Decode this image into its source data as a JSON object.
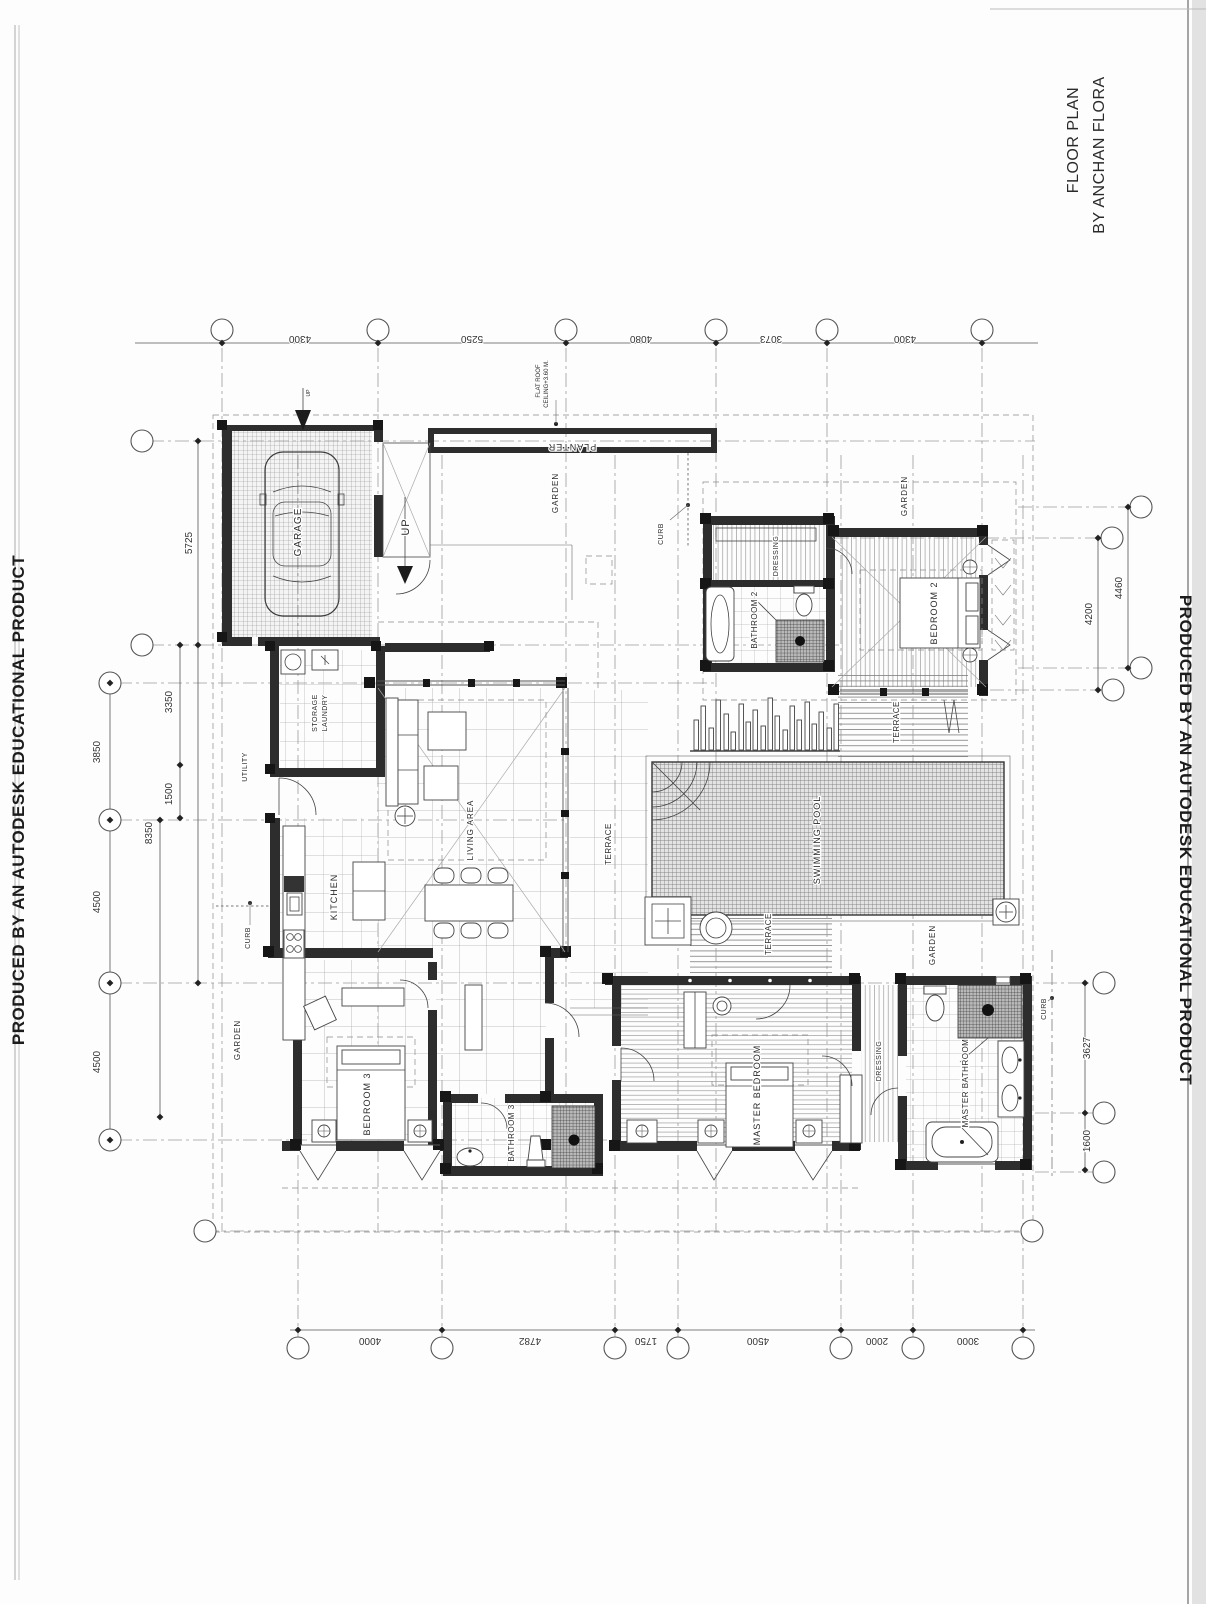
{
  "page": {
    "watermark_left": "PRODUCED BY AN AUTODESK EDUCATIONAL PRODUCT",
    "watermark_right": "PRODUCED BY AN AUTODESK EDUCATIONAL PRODUCT"
  },
  "title": {
    "line1": "FLOOR PLAN",
    "line2": "BY ANCHAN FLORA"
  },
  "rooms": [
    {
      "n": "garage-label",
      "t": "GARAGE",
      "x": 301,
      "y": 532,
      "r": -90,
      "s": 10,
      "sp": 1
    },
    {
      "n": "up-stair-label",
      "t": "UP",
      "x": 409,
      "y": 527,
      "r": -90,
      "s": 11,
      "sp": 1
    },
    {
      "n": "up-entry-label",
      "t": "UP",
      "x": 310,
      "y": 393,
      "r": -90,
      "s": 5,
      "sp": 0
    },
    {
      "n": "flat-roof-note-1",
      "t": "FLAT ROOF",
      "x": 540,
      "y": 381,
      "r": -90,
      "s": 6,
      "sp": 0
    },
    {
      "n": "flat-roof-note-2",
      "t": "CEILING+3.60 M.",
      "x": 548,
      "y": 384,
      "r": -90,
      "s": 6,
      "sp": 0
    },
    {
      "n": "planter-label",
      "t": "PLANTER",
      "x": 572,
      "y": 444,
      "r": 180,
      "s": 9,
      "sp": 1
    },
    {
      "n": "garden-top-label",
      "t": "GARDEN",
      "x": 558,
      "y": 493,
      "r": -90,
      "s": 8,
      "sp": 1
    },
    {
      "n": "curb-top-label",
      "t": "CURB",
      "x": 663,
      "y": 534,
      "r": -90,
      "s": 7,
      "sp": 0.5
    },
    {
      "n": "garden-tr-label",
      "t": "GARDEN",
      "x": 907,
      "y": 496,
      "r": -90,
      "s": 8,
      "sp": 1
    },
    {
      "n": "dressing2-label",
      "t": "DRESSING",
      "x": 778,
      "y": 556,
      "r": -90,
      "s": 7,
      "sp": 0.5
    },
    {
      "n": "bathroom2-label",
      "t": "BATHROOM 2",
      "x": 757,
      "y": 620,
      "r": -90,
      "s": 8,
      "sp": 0.5
    },
    {
      "n": "bedroom2-label",
      "t": "BEDROOM 2",
      "x": 937,
      "y": 613,
      "r": -90,
      "s": 9,
      "sp": 1
    },
    {
      "n": "terrace2-label",
      "t": "TERRACE",
      "x": 899,
      "y": 722,
      "r": -90,
      "s": 8,
      "sp": 0.5
    },
    {
      "n": "swimming-pool-label",
      "t": "SWIMMING POOL",
      "x": 820,
      "y": 840,
      "r": -90,
      "s": 9,
      "sp": 1
    },
    {
      "n": "terrace-main-label",
      "t": "TERRACE",
      "x": 611,
      "y": 844,
      "r": -90,
      "s": 8,
      "sp": 0.5
    },
    {
      "n": "terrace-low-label",
      "t": "TERRACE",
      "x": 771,
      "y": 934,
      "r": -90,
      "s": 8,
      "sp": 0.5
    },
    {
      "n": "storage-label",
      "t": "STORAGE",
      "x": 317,
      "y": 713,
      "r": -90,
      "s": 7,
      "sp": 0.5
    },
    {
      "n": "laundry-label",
      "t": "LAUNDRY",
      "x": 327,
      "y": 713,
      "r": -90,
      "s": 7,
      "sp": 0.5
    },
    {
      "n": "utility-label",
      "t": "UTILITY",
      "x": 247,
      "y": 767,
      "r": -90,
      "s": 7,
      "sp": 0.5
    },
    {
      "n": "kitchen-label",
      "t": "KITCHEN",
      "x": 337,
      "y": 897,
      "r": -90,
      "s": 9,
      "sp": 1
    },
    {
      "n": "living-area-label",
      "t": "LIVING AREA",
      "x": 473,
      "y": 830,
      "r": -90,
      "s": 8,
      "sp": 1
    },
    {
      "n": "curb-left-label",
      "t": "CURB",
      "x": 250,
      "y": 938,
      "r": -90,
      "s": 7,
      "sp": 0.5
    },
    {
      "n": "garden-left-label",
      "t": "GARDEN",
      "x": 240,
      "y": 1040,
      "r": -90,
      "s": 8,
      "sp": 1
    },
    {
      "n": "bedroom3-label",
      "t": "BEDROOM 3",
      "x": 370,
      "y": 1104,
      "r": -90,
      "s": 9,
      "sp": 1
    },
    {
      "n": "bathroom3-label",
      "t": "BATHROOM 3",
      "x": 514,
      "y": 1133,
      "r": -90,
      "s": 8,
      "sp": 0.5
    },
    {
      "n": "master-bedroom-label",
      "t": "MASTER BEDROOM",
      "x": 760,
      "y": 1095,
      "r": -90,
      "s": 9,
      "sp": 1
    },
    {
      "n": "dressing-master-label",
      "t": "DRESSING",
      "x": 881,
      "y": 1061,
      "r": -90,
      "s": 7,
      "sp": 0.5
    },
    {
      "n": "master-bathroom-label",
      "t": "MASTER BATHROOM",
      "x": 968,
      "y": 1083,
      "r": -90,
      "s": 8,
      "sp": 0.5
    },
    {
      "n": "garden-right-label",
      "t": "GARDEN",
      "x": 935,
      "y": 945,
      "r": -90,
      "s": 8,
      "sp": 1
    },
    {
      "n": "curb-right-label",
      "t": "CURB",
      "x": 1046,
      "y": 1009,
      "r": -90,
      "s": 7,
      "sp": 0.5
    }
  ],
  "dimensions": {
    "top": [
      {
        "text": "4300",
        "x": 300,
        "y": 336
      },
      {
        "text": "5250",
        "x": 472,
        "y": 336
      },
      {
        "text": "4080",
        "x": 641,
        "y": 336
      },
      {
        "text": "3073",
        "x": 771,
        "y": 336
      },
      {
        "text": "4300",
        "x": 905,
        "y": 336
      }
    ],
    "bottom": [
      {
        "text": "4000",
        "x": 370,
        "y": 1338
      },
      {
        "text": "4782",
        "x": 530,
        "y": 1338
      },
      {
        "text": "1750",
        "x": 646,
        "y": 1338
      },
      {
        "text": "4500",
        "x": 758,
        "y": 1338
      },
      {
        "text": "2000",
        "x": 877,
        "y": 1338
      },
      {
        "text": "3000",
        "x": 968,
        "y": 1338
      }
    ],
    "left": [
      {
        "text": "5725",
        "x": 192,
        "y": 543
      },
      {
        "text": "3350",
        "x": 172,
        "y": 702
      },
      {
        "text": "3850",
        "x": 100,
        "y": 752
      },
      {
        "text": "1500",
        "x": 172,
        "y": 794
      },
      {
        "text": "8350",
        "x": 152,
        "y": 833
      },
      {
        "text": "4500",
        "x": 100,
        "y": 902
      },
      {
        "text": "4500",
        "x": 100,
        "y": 1062
      }
    ],
    "right": [
      {
        "text": "4460",
        "x": 1122,
        "y": 588
      },
      {
        "text": "4200",
        "x": 1092,
        "y": 614
      },
      {
        "text": "3627",
        "x": 1090,
        "y": 1048
      },
      {
        "text": "1600",
        "x": 1090,
        "y": 1141
      }
    ]
  },
  "grid_bubbles": [
    {
      "x": 222,
      "y": 330
    },
    {
      "x": 378,
      "y": 330
    },
    {
      "x": 566,
      "y": 330
    },
    {
      "x": 716,
      "y": 330
    },
    {
      "x": 827,
      "y": 330
    },
    {
      "x": 982,
      "y": 330
    },
    {
      "x": 298,
      "y": 1348
    },
    {
      "x": 442,
      "y": 1348
    },
    {
      "x": 615,
      "y": 1348
    },
    {
      "x": 678,
      "y": 1348
    },
    {
      "x": 841,
      "y": 1348
    },
    {
      "x": 913,
      "y": 1348
    },
    {
      "x": 1023,
      "y": 1348
    },
    {
      "x": 142,
      "y": 441
    },
    {
      "x": 142,
      "y": 645
    },
    {
      "x": 110,
      "y": 683
    },
    {
      "x": 110,
      "y": 820
    },
    {
      "x": 110,
      "y": 983
    },
    {
      "x": 110,
      "y": 1140
    },
    {
      "x": 205,
      "y": 1231
    },
    {
      "x": 1141,
      "y": 507
    },
    {
      "x": 1112,
      "y": 538
    },
    {
      "x": 1141,
      "y": 668
    },
    {
      "x": 1113,
      "y": 690
    },
    {
      "x": 1104,
      "y": 983
    },
    {
      "x": 1104,
      "y": 1113
    },
    {
      "x": 1104,
      "y": 1172
    },
    {
      "x": 1032,
      "y": 1231
    }
  ]
}
